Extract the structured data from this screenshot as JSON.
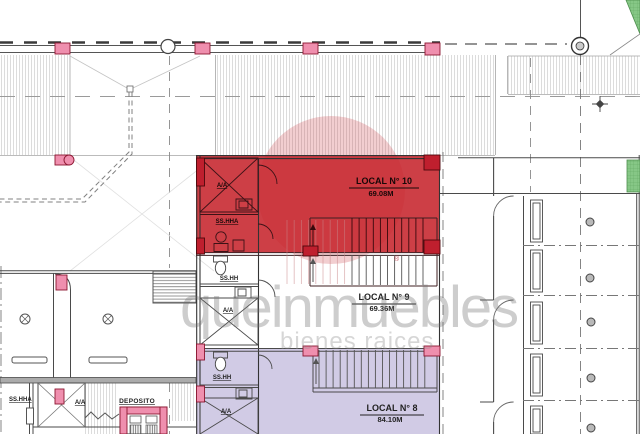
{
  "locals": [
    {
      "name": "LOCAL N° 10",
      "area": "69.08M"
    },
    {
      "name": "LOCAL N° 9",
      "area": "69.36M"
    },
    {
      "name": "LOCAL N° 8",
      "area": "84.10M"
    }
  ],
  "rooms": {
    "ac": "A/A",
    "bath_suite": "SS.HHA",
    "bath": "SS.HH",
    "deposit": "DEPOSITO"
  },
  "watermark": {
    "brand": "queinmuebles",
    "tagline": "bienes raices",
    "registered": "®"
  },
  "colors": {
    "zone_red": "#c5232b",
    "zone_purple": "#ccc5e2",
    "column_pink": "#ef8fae",
    "column_crimson": "#bf1f2e",
    "green_area": "#86c786",
    "logo_red": "#cf4a50",
    "watermark_gray": "#6f6f6f",
    "line": "#4a4a4a"
  }
}
